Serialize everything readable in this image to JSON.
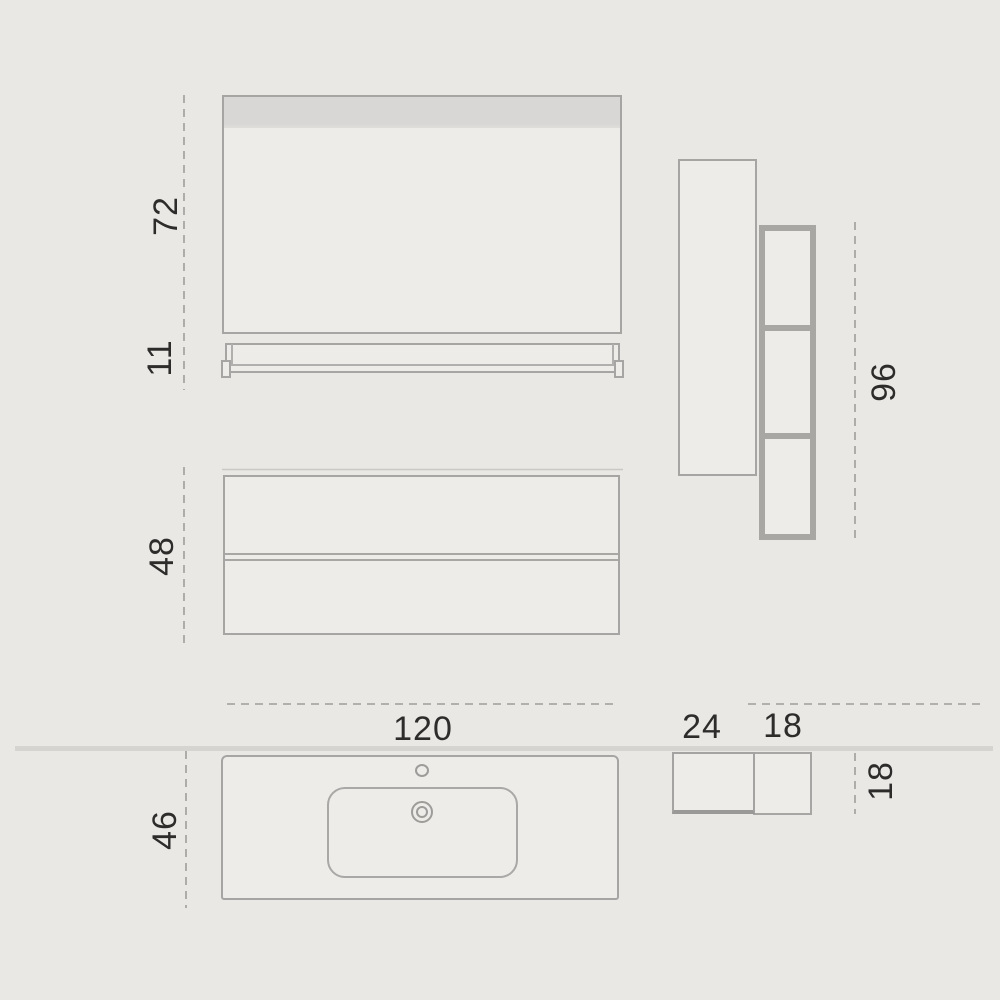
{
  "dimensions": {
    "front_view": {
      "mirror_height": "72",
      "shelf_height": "11",
      "vanity_height": "48"
    },
    "side_view": {
      "column_height": "96"
    },
    "plan_view": {
      "top_width": "120",
      "top_depth": "46",
      "side_unit_a_width": "24",
      "side_unit_b_width": "18",
      "side_unit_depth": "18"
    }
  },
  "colors": {
    "background": "#eae8e5",
    "surface": "#edece9",
    "mirror_band": "#d8d7d5",
    "outline": "#a7a5a3",
    "outline_thick": "#a9a7a4",
    "wall_line": "#d6d4d1",
    "dashed_line": "#a09e9b",
    "text": "#2d2c2b"
  }
}
